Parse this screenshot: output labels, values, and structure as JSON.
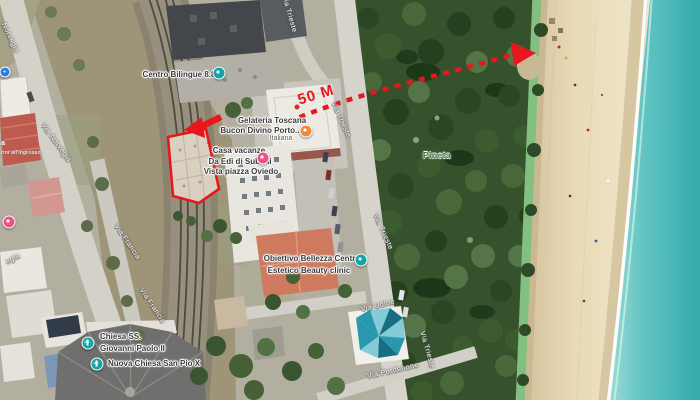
{
  "annotations": {
    "distance_label": "50 M",
    "annotation_color": "#e8161d"
  },
  "streets": {
    "norvegia_top_partial": "Norvegia",
    "via_norvegia": "Via Norvegia",
    "norvegia_bottom_partial": "egia",
    "via_francia_upper": "Via Francia",
    "via_francia_lower": "Via Francia",
    "via_trieste_top": "Via Trieste",
    "via_trieste_mid": "Via Trieste",
    "via_trieste_lower": "Via Trieste",
    "via_trieste_bottom": "Via Trieste",
    "via_udine": "Via Udine",
    "via_pordenone": "Via Pordenone"
  },
  "areas": {
    "pineta": "Pineta"
  },
  "pois": {
    "centro_bilingue": {
      "name": "Centro Bilingue 8.8",
      "icon": "school-icon",
      "icon_color": "#12a5a5"
    },
    "gelateria": {
      "line1": "Gelateria Toscana",
      "line2": "Bucon Divino Porto...",
      "line3": "Italiana",
      "icon": "restaurant-icon",
      "icon_color": "#ef8a41"
    },
    "casa_vacanze": {
      "line1": "Casa vacanze",
      "line2": "Da Edi di Subioli",
      "line3": "Vista piazza Oviedo",
      "icon": "lodging-icon",
      "icon_color": "#e9538c"
    },
    "obiettivo_bellezza": {
      "line1": "Obiettivo Bellezza Centro",
      "line2": "Estetico Beauty clinic",
      "icon": "spa-icon",
      "icon_color": "#12a5a5"
    },
    "chiesa_ss": {
      "line1": "Chiesa SS.",
      "line2": "Giovanni Paolo II",
      "icon": "church-icon",
      "icon_color": "#12a5a5"
    },
    "nuova_chiesa": {
      "name": "Nuova Chiesa San Pio X",
      "icon": "church-icon",
      "icon_color": "#12a5a5"
    },
    "warehouse_partial": {
      "line1": "ria",
      "line2": "azzini all'ingrosso"
    },
    "left_edge_blue_icon_color": "#2a7de1",
    "left_edge_pink_icon_color": "#e9538c"
  }
}
